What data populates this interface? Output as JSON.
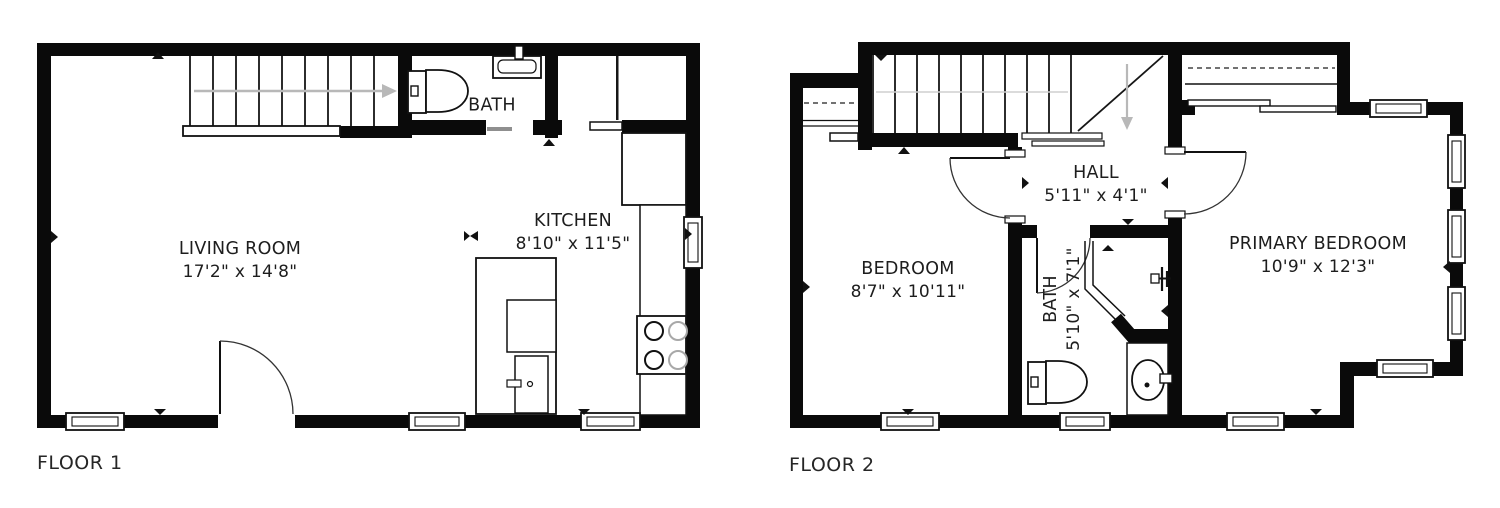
{
  "title": "Two floor residential floor plan",
  "floor1": {
    "label": "FLOOR 1",
    "rooms": {
      "living_room": {
        "name": "LIVING ROOM",
        "dims": "17'2\" x 14'8\""
      },
      "kitchen": {
        "name": "KITCHEN",
        "dims": "8'10\" x 11'5\""
      },
      "bath": {
        "name": "BATH"
      }
    }
  },
  "floor2": {
    "label": "FLOOR 2",
    "rooms": {
      "bedroom": {
        "name": "BEDROOM",
        "dims": "8'7\" x 10'11\""
      },
      "hall": {
        "name": "HALL",
        "dims": "5'11\" x 4'1\""
      },
      "bath": {
        "name": "BATH",
        "dims": "5'10\" x 7'1\""
      },
      "primary_bedroom": {
        "name": "PRIMARY BEDROOM",
        "dims": "10'9\" x 12'3\""
      }
    }
  },
  "colors": {
    "wall": "#0a0a0a",
    "line": "#1a1a1a",
    "stair_arrow": "#b8b8b8",
    "text": "#1d1d1d"
  },
  "icons": [
    "stairs-icon",
    "toilet-icon",
    "sink-icon",
    "stove-icon",
    "fridge-icon",
    "shower-icon",
    "door-swing-icon",
    "window-icon",
    "light-fixture-icon"
  ]
}
